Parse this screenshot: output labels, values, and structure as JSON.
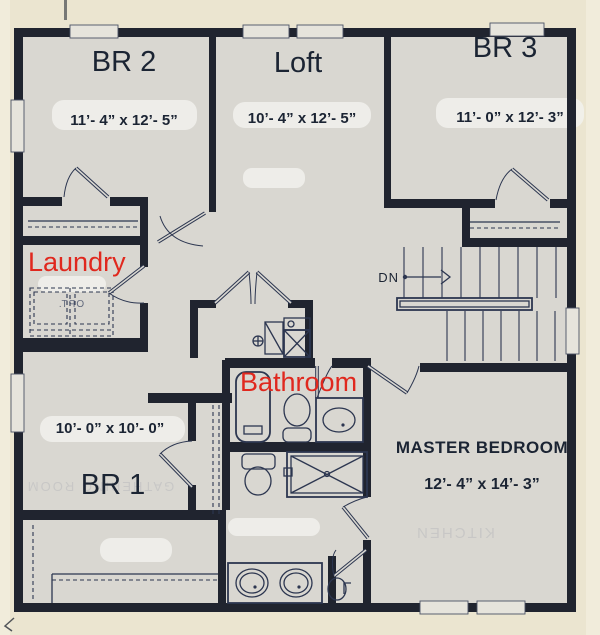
{
  "palette": {
    "page_bg": "#ebe5d0",
    "page_edge": "#f4efdf",
    "floor": "#d9d7d1",
    "wall": "#20242f",
    "line": "#2c3650",
    "red": "#e0281e",
    "ink": "#1b2433",
    "window_fill": "#e6e4dc",
    "patch": "#f2f3ef"
  },
  "rooms": {
    "br2": {
      "label": "BR 2",
      "dims": "11’- 4” x 12’- 5”"
    },
    "loft": {
      "label": "Loft",
      "dims": "10’- 4” x 12’- 5”"
    },
    "br3": {
      "label": "BR 3",
      "dims": "11’- 0” x 12’- 3”"
    },
    "br1": {
      "label": "BR 1",
      "dims": "10’- 0” x 10’- 0”"
    },
    "master": {
      "label": "MASTER BEDROOM",
      "dims": "12’- 4” x 14’- 3”"
    },
    "laundry": {
      "label": "Laundry"
    },
    "bathroom": {
      "label": "Bathroom"
    }
  },
  "stairs": {
    "dn_label": "DN"
  },
  "artifacts": {
    "opt": "OPT.",
    "ghost_br1": "GATHERING ROOM",
    "ghost_master": "KITCHEN"
  }
}
